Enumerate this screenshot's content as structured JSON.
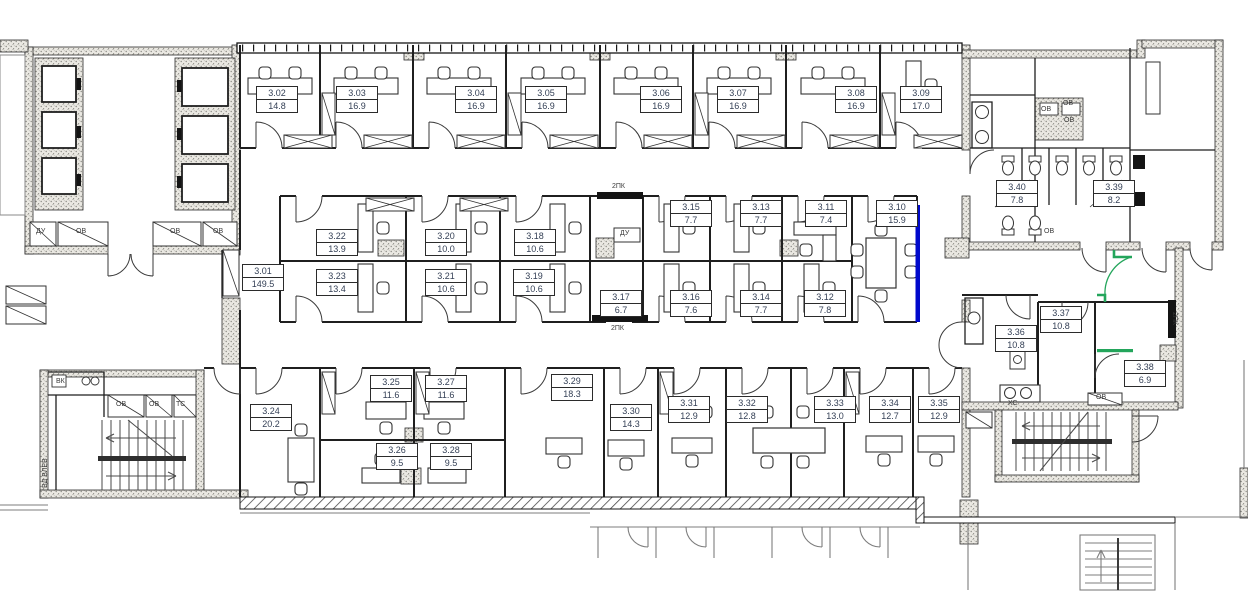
{
  "title": "Office floor plan, level 3",
  "colors": {
    "wall": "#1f1f1f",
    "hatch_fill": "#eae8e2",
    "accent_blue": "#0009cc",
    "accent_green": "#23a55b",
    "label_text": "#333f55",
    "neighbor_gray": "#7d7d7d"
  },
  "rooms": [
    {
      "id": "3.01",
      "area": "149.5",
      "x": 242,
      "y": 264
    },
    {
      "id": "3.02",
      "area": "14.8",
      "x": 256,
      "y": 86
    },
    {
      "id": "3.03",
      "area": "16.9",
      "x": 336,
      "y": 86
    },
    {
      "id": "3.04",
      "area": "16.9",
      "x": 455,
      "y": 86
    },
    {
      "id": "3.05",
      "area": "16.9",
      "x": 525,
      "y": 86
    },
    {
      "id": "3.06",
      "area": "16.9",
      "x": 640,
      "y": 86
    },
    {
      "id": "3.07",
      "area": "16.9",
      "x": 717,
      "y": 86
    },
    {
      "id": "3.08",
      "area": "16.9",
      "x": 835,
      "y": 86
    },
    {
      "id": "3.09",
      "area": "17.0",
      "x": 900,
      "y": 86
    },
    {
      "id": "3.10",
      "area": "15.9",
      "x": 876,
      "y": 200
    },
    {
      "id": "3.11",
      "area": "7.4",
      "x": 805,
      "y": 200
    },
    {
      "id": "3.12",
      "area": "7.8",
      "x": 804,
      "y": 290
    },
    {
      "id": "3.13",
      "area": "7.7",
      "x": 740,
      "y": 200
    },
    {
      "id": "3.14",
      "area": "7.7",
      "x": 740,
      "y": 290
    },
    {
      "id": "3.15",
      "area": "7.7",
      "x": 670,
      "y": 200
    },
    {
      "id": "3.16",
      "area": "7.6",
      "x": 670,
      "y": 290
    },
    {
      "id": "3.17",
      "area": "6.7",
      "x": 600,
      "y": 290
    },
    {
      "id": "3.18",
      "area": "10.6",
      "x": 514,
      "y": 229
    },
    {
      "id": "3.19",
      "area": "10.6",
      "x": 513,
      "y": 269
    },
    {
      "id": "3.20",
      "area": "10.0",
      "x": 425,
      "y": 229
    },
    {
      "id": "3.21",
      "area": "10.6",
      "x": 425,
      "y": 269
    },
    {
      "id": "3.22",
      "area": "13.9",
      "x": 316,
      "y": 229
    },
    {
      "id": "3.23",
      "area": "13.4",
      "x": 316,
      "y": 269
    },
    {
      "id": "3.24",
      "area": "20.2",
      "x": 250,
      "y": 404
    },
    {
      "id": "3.25",
      "area": "11.6",
      "x": 370,
      "y": 375
    },
    {
      "id": "3.26",
      "area": "9.5",
      "x": 376,
      "y": 443
    },
    {
      "id": "3.27",
      "area": "11.6",
      "x": 425,
      "y": 375
    },
    {
      "id": "3.28",
      "area": "9.5",
      "x": 430,
      "y": 443
    },
    {
      "id": "3.29",
      "area": "18.3",
      "x": 551,
      "y": 374
    },
    {
      "id": "3.30",
      "area": "14.3",
      "x": 610,
      "y": 404
    },
    {
      "id": "3.31",
      "area": "12.9",
      "x": 668,
      "y": 396
    },
    {
      "id": "3.32",
      "area": "12.8",
      "x": 726,
      "y": 396
    },
    {
      "id": "3.33",
      "area": "13.0",
      "x": 814,
      "y": 396
    },
    {
      "id": "3.34",
      "area": "12.7",
      "x": 869,
      "y": 396
    },
    {
      "id": "3.35",
      "area": "12.9",
      "x": 918,
      "y": 396
    },
    {
      "id": "3.36",
      "area": "10.8",
      "x": 995,
      "y": 325
    },
    {
      "id": "3.37",
      "area": "10.8",
      "x": 1040,
      "y": 306
    },
    {
      "id": "3.38",
      "area": "6.9",
      "x": 1124,
      "y": 360
    },
    {
      "id": "3.39",
      "area": "8.2",
      "x": 1093,
      "y": 180
    },
    {
      "id": "3.40",
      "area": "7.8",
      "x": 996,
      "y": 180
    }
  ],
  "annotations": [
    {
      "t": "ДУ",
      "x": 36,
      "y": 228
    },
    {
      "t": "ОВ",
      "x": 76,
      "y": 228
    },
    {
      "t": "ОВ",
      "x": 170,
      "y": 228
    },
    {
      "t": "ОВ",
      "x": 213,
      "y": 228
    },
    {
      "t": "ДУ",
      "x": 620,
      "y": 230
    },
    {
      "t": "2ПК",
      "x": 612,
      "y": 183
    },
    {
      "t": "2ПК",
      "x": 611,
      "y": 325
    },
    {
      "t": "2ПК",
      "x": 1178,
      "y": 312,
      "r": 90
    },
    {
      "t": "ОВ",
      "x": 1041,
      "y": 106
    },
    {
      "t": "ОВ",
      "x": 1063,
      "y": 100
    },
    {
      "t": "ОВ",
      "x": 1064,
      "y": 117
    },
    {
      "t": "ОВ",
      "x": 1044,
      "y": 228
    },
    {
      "t": "ВК",
      "x": 56,
      "y": 378
    },
    {
      "t": "ОВ",
      "x": 116,
      "y": 401
    },
    {
      "t": "ОВ",
      "x": 149,
      "y": 401
    },
    {
      "t": "ТС",
      "x": 176,
      "y": 401
    },
    {
      "t": "ХС",
      "x": 1008,
      "y": 400
    },
    {
      "t": "ОВ",
      "x": 1096,
      "y": 394
    },
    {
      "t": "ВД ВЛЕВ",
      "x": 42,
      "y": 488,
      "r": -90
    }
  ]
}
